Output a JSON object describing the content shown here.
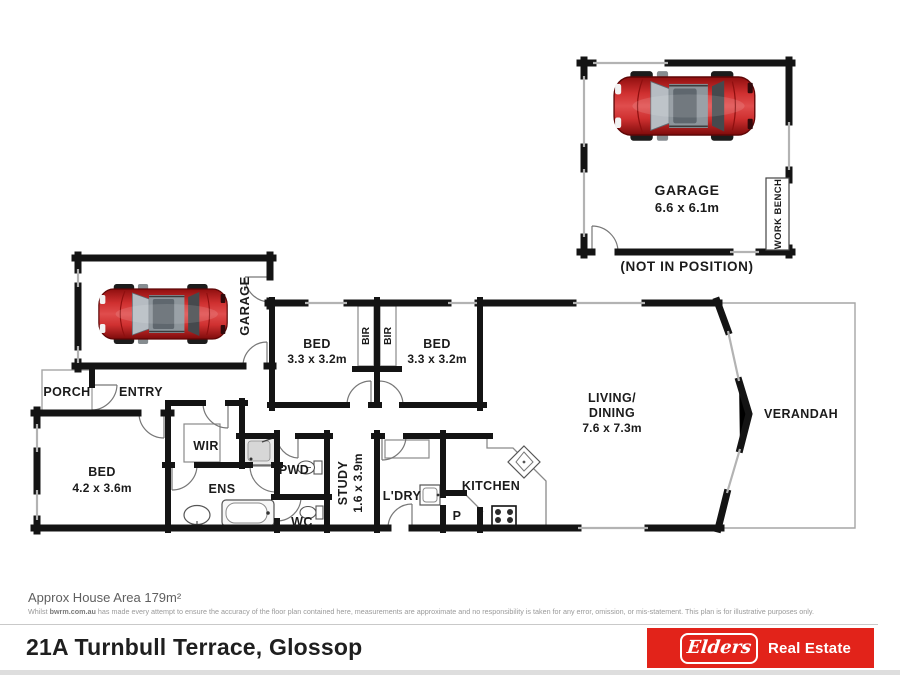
{
  "plan": {
    "detached_garage": {
      "label": "GARAGE",
      "dims": "6.6 x 6.1m",
      "workbench_label": "WORK BENCH",
      "note": "(NOT IN POSITION)"
    },
    "rooms": {
      "garage": {
        "label": "GARAGE"
      },
      "porch": {
        "label": "PORCH"
      },
      "entry": {
        "label": "ENTRY"
      },
      "bed1": {
        "label": "BED",
        "dims": "3.3 x 3.2m"
      },
      "bir1": {
        "label": "BIR"
      },
      "bir2": {
        "label": "BIR"
      },
      "bed2": {
        "label": "BED",
        "dims": "3.3 x 3.2m"
      },
      "living_dining": {
        "label_line1": "LIVING/",
        "label_line2": "DINING",
        "dims": "7.6 x 7.3m"
      },
      "verandah": {
        "label": "VERANDAH"
      },
      "bed_master": {
        "label": "BED",
        "dims": "4.2 x 3.6m"
      },
      "wir": {
        "label": "WIR"
      },
      "ens": {
        "label": "ENS"
      },
      "pwd": {
        "label": "PWD"
      },
      "wc": {
        "label": "WC"
      },
      "study": {
        "label": "STUDY",
        "dims": "1.6 x 3.9m"
      },
      "laundry": {
        "label": "L'DRY"
      },
      "pantry": {
        "label": "P"
      },
      "kitchen": {
        "label": "KITCHEN"
      }
    },
    "icons": {
      "car": "red-car-top-view",
      "shower": "shower",
      "bath": "bathtub",
      "toilet": "toilet",
      "basin": "basin",
      "laundry_tub": "laundry-tub",
      "kitchen_sink": "kitchen-sink",
      "cooktop": "cooktop",
      "door": "door-swing-arc"
    }
  },
  "footer": {
    "area_note": "Approx House Area 179m²",
    "disclaimer": {
      "prefix": "Whilst ",
      "bold": "bwrm.com.au",
      "rest": " has made every attempt to ensure the accuracy of the floor plan contained here, measurements are approximate and no responsibility is taken for any error, omission, or mis-statement. This plan is for illustrative purposes only."
    },
    "address": "21A Turnbull Terrace, Glossop",
    "brand": {
      "logo_text": "Elders",
      "tagline": "Real Estate",
      "brand_red": "#e2231a"
    }
  }
}
